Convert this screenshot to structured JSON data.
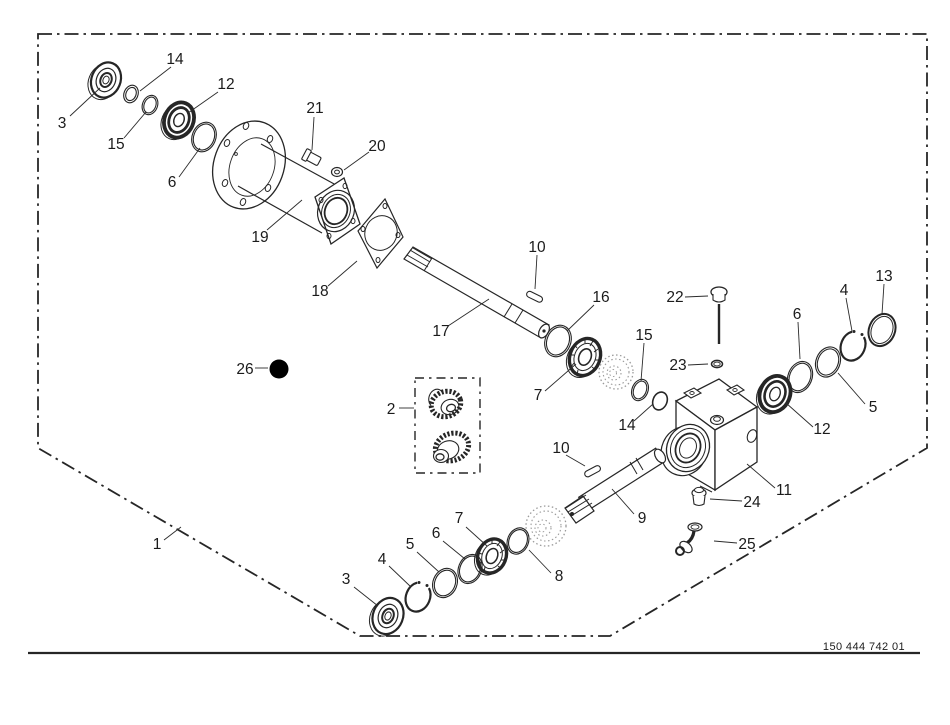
{
  "drawing_number": "150 444 742 01",
  "diagram_type": "exploded-parts-diagram-gearbox",
  "colors": {
    "line": "#262626",
    "ghost_part": "#9a9a9a",
    "background": "#ffffff",
    "solid_marker": "#000000"
  },
  "callouts": [
    {
      "label": "3"
    },
    {
      "label": "14"
    },
    {
      "label": "15"
    },
    {
      "label": "12"
    },
    {
      "label": "6"
    },
    {
      "label": "19"
    },
    {
      "label": "21"
    },
    {
      "label": "20"
    },
    {
      "label": "18"
    },
    {
      "label": "17"
    },
    {
      "label": "10"
    },
    {
      "label": "16"
    },
    {
      "label": "7"
    },
    {
      "label": "15"
    },
    {
      "label": "14"
    },
    {
      "label": "22"
    },
    {
      "label": "23"
    },
    {
      "label": "6"
    },
    {
      "label": "4"
    },
    {
      "label": "13"
    },
    {
      "label": "5"
    },
    {
      "label": "12"
    },
    {
      "label": "11"
    },
    {
      "label": "2"
    },
    {
      "label": "26"
    },
    {
      "label": "10"
    },
    {
      "label": "9"
    },
    {
      "label": "24"
    },
    {
      "label": "25"
    },
    {
      "label": "8"
    },
    {
      "label": "7"
    },
    {
      "label": "6"
    },
    {
      "label": "5"
    },
    {
      "label": "4"
    },
    {
      "label": "3"
    },
    {
      "label": "1"
    }
  ]
}
